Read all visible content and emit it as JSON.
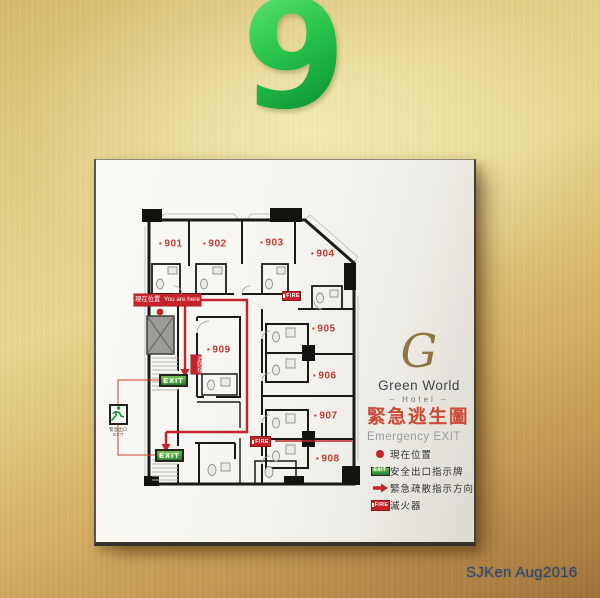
{
  "scene": {
    "floor_number": "9",
    "watermark": "SJKen Aug2016"
  },
  "sign": {
    "logo": {
      "letter": "G",
      "name": "Green World",
      "subtitle": "– Hotel –"
    },
    "title": {
      "zh": "緊急逃生圖",
      "en": "Emergency EXIT"
    },
    "legend": [
      {
        "icon": "location-dot-icon",
        "label": "現在位置"
      },
      {
        "icon": "exit-sign-icon",
        "icon_text": "EXIT",
        "label": "安全出口指示牌"
      },
      {
        "icon": "direction-arrow-icon",
        "label": "緊急疏散指示方向"
      },
      {
        "icon": "fire-extinguisher-icon",
        "icon_text": "FIRE",
        "label": "滅火器"
      }
    ],
    "plan": {
      "rooms": [
        "901",
        "902",
        "903",
        "904",
        "905",
        "906",
        "907",
        "908",
        "909"
      ],
      "you_are_here": {
        "zh": "現在位置",
        "en": "You are here"
      },
      "exit_badge_label": "EXIT",
      "fire_badge_label": "FIRE",
      "hydrant_label": "消防栓",
      "emergency_exit_icon_caption": {
        "zh": "緊急出口",
        "en": "EXIT"
      }
    },
    "colors": {
      "route_red": "#c4232b",
      "exit_green": "#2e8f3c",
      "title_red": "#cb4a33",
      "floor_green": "#22bd49"
    }
  }
}
